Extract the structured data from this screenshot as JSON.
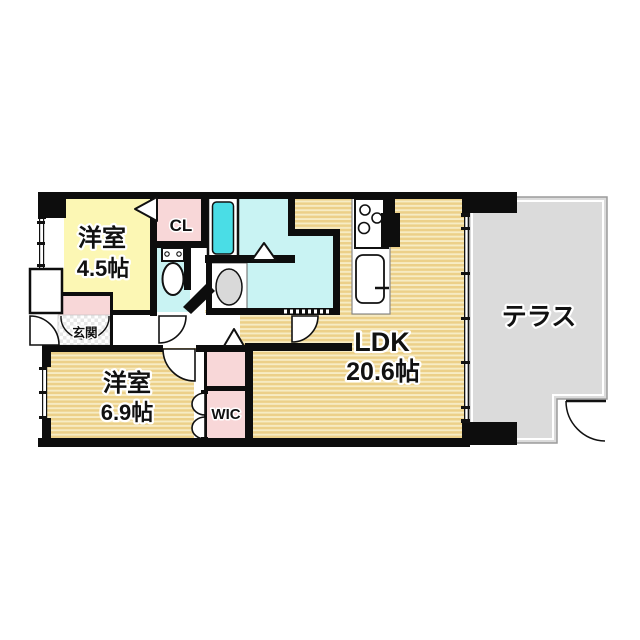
{
  "diagram_type": "japanese-apartment-floor-plan",
  "rooms": {
    "western_room_small": {
      "label": "洋室",
      "size": "4.5帖"
    },
    "western_room_large": {
      "label": "洋室",
      "size": "6.9帖"
    },
    "ldk": {
      "label": "LDK",
      "size": "20.6帖"
    },
    "terrace": {
      "label": "テラス"
    },
    "closet": {
      "label": "CL"
    },
    "walk_in_closet": {
      "label": "WIC"
    },
    "entrance": {
      "label": "玄関"
    }
  },
  "colors": {
    "wood_floor_dark": "#ecd089",
    "wood_floor_light": "#f7ecc4",
    "room_yellow": "#fcf7b4",
    "closet_pink": "#f8d7d8",
    "wet_area_cyan": "#c9f3f3",
    "bathtub_cyan": "#4adde6",
    "terrace_gray": "#dbdbdb",
    "wall_black": "#0d0d0d"
  }
}
